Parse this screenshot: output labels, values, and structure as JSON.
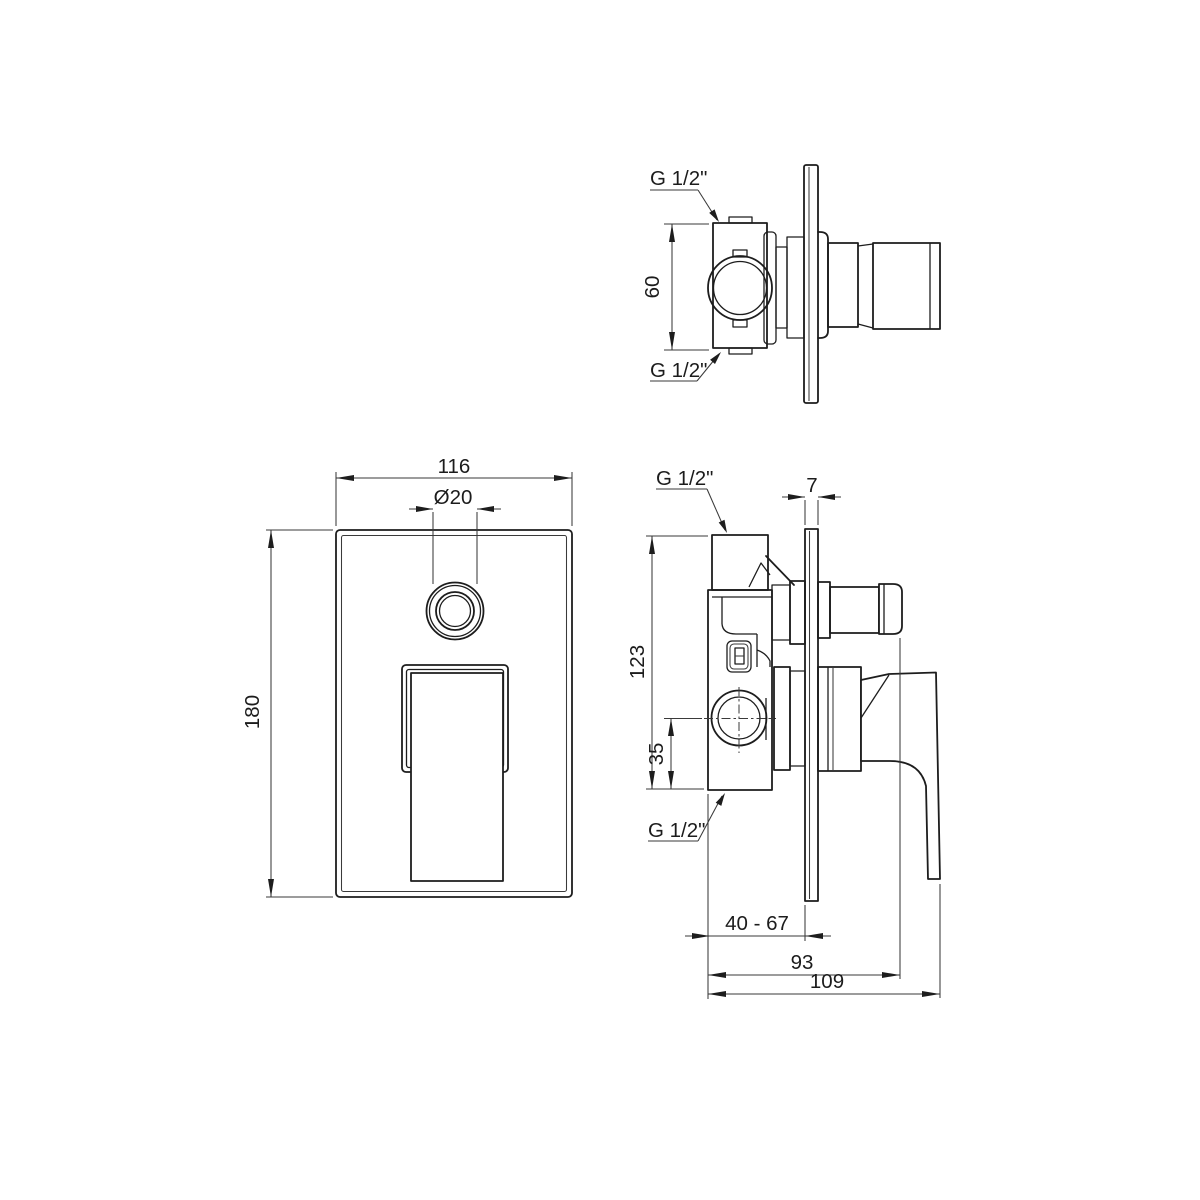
{
  "page": {
    "background": "#ffffff",
    "line_color": "#1d1d1d",
    "description": "Concealed shower mixer valve dimensional drawing, three views"
  },
  "views": {
    "top": {
      "labels": {
        "port_top": "G 1/2\"",
        "port_bottom": "G 1/2\"",
        "dim_port_span": "60"
      }
    },
    "front": {
      "labels": {
        "dim_plate_width": "116",
        "dim_button_diameter": "Ø20",
        "dim_plate_height": "180"
      }
    },
    "side": {
      "labels": {
        "port_top": "G 1/2\"",
        "port_bottom": "G 1/2\"",
        "dim_plate_thickness": "7",
        "dim_body_height": "123",
        "dim_outlet_offset": "35",
        "dim_mounting_depth_range": "40 - 67",
        "dim_depth_to_diverter": "93",
        "dim_total_depth": "109"
      }
    }
  }
}
